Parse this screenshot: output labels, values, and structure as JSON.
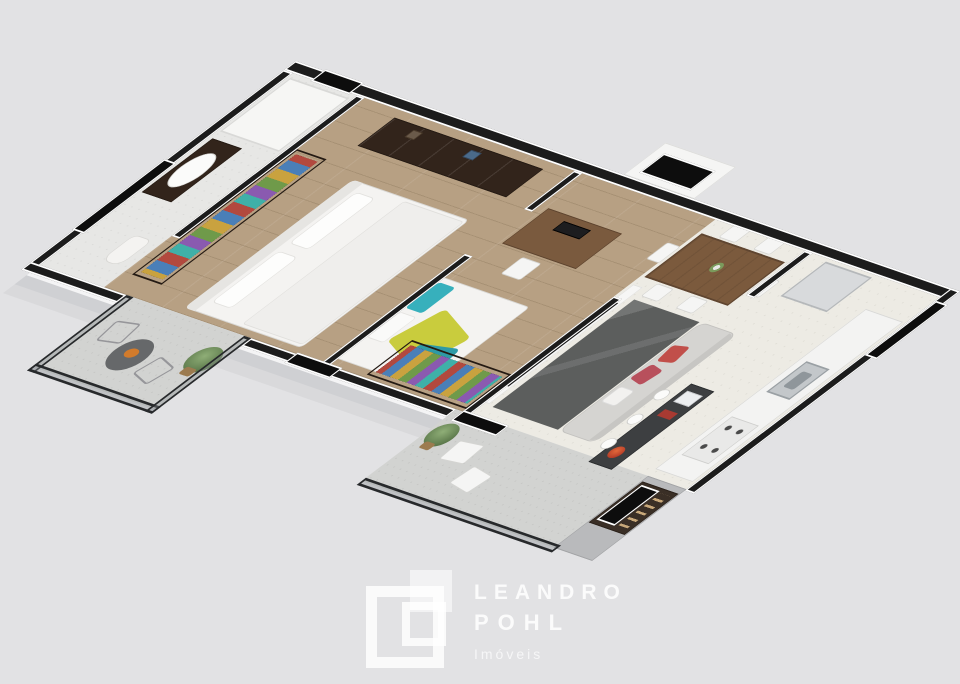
{
  "watermark": {
    "brand_line1": "LEANDRO",
    "brand_line2": "POHL",
    "tagline": "Imóveis",
    "logo_icon": "overlapping-squares-monogram",
    "text_color": "#f2f2f2"
  },
  "palette": {
    "background": "#e2e2e4",
    "wall_top": "#1c1c1c",
    "wall_outline": "#ffffff",
    "wall_face": "#f4f4f5",
    "wood_floor": "#b7a083",
    "stone_floor": "#edebe4",
    "balcony_concrete": "#d2d3d1",
    "glass_railing": "#8a8f94",
    "dark_wood_furniture": "#32241b",
    "sofa_gray": "#d5d4d1",
    "rug_charcoal": "#5c5e5d",
    "bar_counter": "#3d3f41",
    "accent_teal": "#37b0bc",
    "accent_yellow": "#c9cc3d",
    "accent_red": "#c14f4a"
  },
  "floorplan": {
    "view": "3d-isometric-apartment",
    "rooms": [
      {
        "name": "bathroom",
        "floor": "tile",
        "furniture": [
          "shower-box",
          "vanity-with-sink",
          "toilet"
        ]
      },
      {
        "name": "master-bedroom",
        "floor": "wood",
        "furniture": [
          "dresser",
          "open-wardrobe-with-clothes",
          "double-bed"
        ]
      },
      {
        "name": "master-balcony",
        "floor": "concrete",
        "furniture": [
          "round-table",
          "wire-chair",
          "wire-chair",
          "potted-plant"
        ],
        "features": [
          "glass-railing"
        ]
      },
      {
        "name": "bedroom-2",
        "floor": "wood",
        "furniture": [
          "desk-with-computer",
          "desk-chair",
          "single-bed",
          "open-wardrobe-with-clothes"
        ]
      },
      {
        "name": "living-room",
        "floor": "stone",
        "furniture": [
          "tv-panel",
          "charcoal-rug",
          "sofa-with-red-pillows",
          "bar-counter-with-laptop",
          "round-stools"
        ]
      },
      {
        "name": "dining-area",
        "floor": "stone",
        "furniture": [
          "wooden-dining-table",
          "dining-chairs",
          "flower-vase"
        ]
      },
      {
        "name": "kitchen",
        "floor": "stone",
        "furniture": [
          "fridge",
          "counter-with-sink",
          "cooktop"
        ]
      },
      {
        "name": "living-balcony",
        "floor": "concrete",
        "furniture": [
          "potted-plant",
          "white-chair",
          "white-chair",
          "barbecue-grill-with-skewers"
        ],
        "features": [
          "glass-railing"
        ]
      }
    ],
    "openings": [
      "bathroom-window",
      "west-window",
      "entry-door",
      "kitchen-window",
      "master-balcony-door",
      "living-balcony-door"
    ]
  }
}
